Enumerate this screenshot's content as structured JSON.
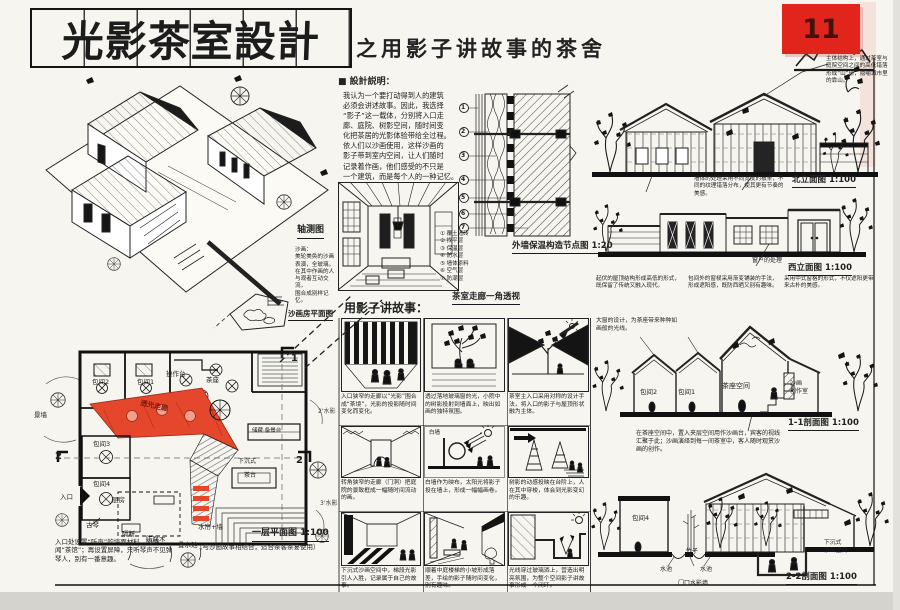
{
  "page": {
    "number": "11"
  },
  "title": {
    "main": "光影茶室設計",
    "subtitle": "之用影子讲故事的茶舍"
  },
  "notes": {
    "heading": "■ 設計説明：",
    "body": "我认为一个要打动得到人的建筑\n必须会讲述故事。因此，我选择\n“影子”这一载体，分别将入口走\n廊、庭院、树影空间，随时间变\n化把茶居的光影体验带给全过程。\n依人们以沙画使用，这样沙画的\n影子带到室内空间，让人们随时\n记录着作画，他们感受的不只是\n一个建筑，而是每个人的一种记忆。"
  },
  "axon": {
    "label": "轴测图",
    "note": "沙画：\n美轮美奂的沙画\n表演，全玻璃，\n在其中作画的人\n与观者互动交流，\n围合成别样记忆。",
    "mini_plan_caption": "沙画房平面图"
  },
  "perspective": {
    "caption": "茶室走廊一角透视"
  },
  "detail": {
    "caption": "外墙保温构造节点图 1:20",
    "legend": "① 覆土墙砖\n② 找平层\n③ 保温层\n④ 防水层\n⑤ 墙体原料\n⑥ 空气层\n⑦ 防潮层",
    "callouts": [
      "1",
      "2",
      "3",
      "4",
      "5",
      "6",
      "7"
    ]
  },
  "story": {
    "heading": "用影子讲故事：",
    "white_wall": "白墙",
    "panels": [
      {
        "caption": "入口狭窄的走廊以“光影”围合成“茶境”，光影的投影随时间变化而变化。"
      },
      {
        "caption": "透过落地玻璃窗的光，小院中的树影投射到墙面上，映出如画的独特氛围。"
      },
      {
        "caption": "茶室主入口采用对称的设计手法，将入口的影子与屋顶形状融为主体。"
      },
      {
        "caption": "转角狭窄的走廊（门洞）把庭院的景致框成一幅随时间流动的画。"
      },
      {
        "caption": "白墙作为映布，太阳光将影子投在墙上，形成一幅幅画卷。"
      },
      {
        "caption": "树影的动感投映在台阶上，人在其中穿梭，体会到光影变幻的乐趣。"
      },
      {
        "caption": "下沉式沙画空间中，梯段光影引人入胜，记录属于自己的故事。"
      },
      {
        "caption": "顺着中庭楼梯的小坡形成落差，手绘的影子随时间变化，别有趣味。"
      },
      {
        "caption": "光线穿过玻璃洒上，营造出明亮氛围，为整个空间影子讲故事形成一个闭环。"
      }
    ]
  },
  "plan": {
    "caption": "一层平面图 1:100",
    "caption_note": "（与沙画故事相结合，适合茶客茶宴使用）",
    "side_note": "入口处设置“听声”的墙面材料，隔墙闻“茶馆”；再设置屏障，只听琴声不见弹琴人，别有一番意趣。",
    "corridor": "透光走廊",
    "rooms": {
      "r2": "包间2",
      "r1": "包间1",
      "counter": "操作台",
      "tea": "茶座",
      "r3": "包间3",
      "r4": "包间4",
      "kitchen": "厨房",
      "storage": "储藏·备餐台",
      "teatable": "茶台",
      "sunken": "下沉式"
    },
    "labels": {
      "scenic_wall": "景墙",
      "entrance": "入口",
      "guqin": "古琴",
      "partition": "隔断",
      "wood": "防腐木",
      "pool": "叠水池",
      "curtain": "水帘+墙",
      "mark_a": "2'水影",
      "mark_b": "3'水影"
    },
    "markers": {
      "m1": "1",
      "m2": "2"
    }
  },
  "elev_north": {
    "caption": "北立面图 1:100",
    "note_top": "主体结构上，通过茶室与庭院空间之间的高低错落形成“山”形，隐喻城市里的靠山。",
    "note_bottom": "墙体的处理采用不同宽度的板条，不同的纹理错落分布，使其更有节奏的美感。"
  },
  "elev_west": {
    "caption": "西立面图 1:100",
    "window_label": "窗户的处理",
    "note1": "起伏的屋顶结构形成高低的形式，既保留了传统又融入现代。",
    "note2": "包间外的窗棂采用渐变铺装的手法，形成遮阳感，既防西晒又别有趣味。",
    "note3": "采用中式窗格的形式，不仅遮阳更带来古朴的美感。"
  },
  "sec11": {
    "caption": "1-1剖面图 1:100",
    "rooms": {
      "r2": "包间2",
      "r1": "包间1",
      "tea": "茶座空间",
      "studio": "沙画\n创作室"
    },
    "note_top": "大窗的设计，为茶座带来种种如画般的光线。",
    "note_bottom": "在茶座空间中，置入夹层空间用作沙画台，宾客的视线汇聚于此；沙画演绎到每一间茶室中，客人随时观赏沙画的创作。"
  },
  "sec22": {
    "caption": "2-2剖面图 1:100",
    "room": "包间4",
    "labels": {
      "pool1": "水池",
      "pool2": "水池",
      "bamboo": "竹子",
      "sunken": "下沉式\n沙画空间",
      "gate_wall": "门口水影墙"
    }
  }
}
